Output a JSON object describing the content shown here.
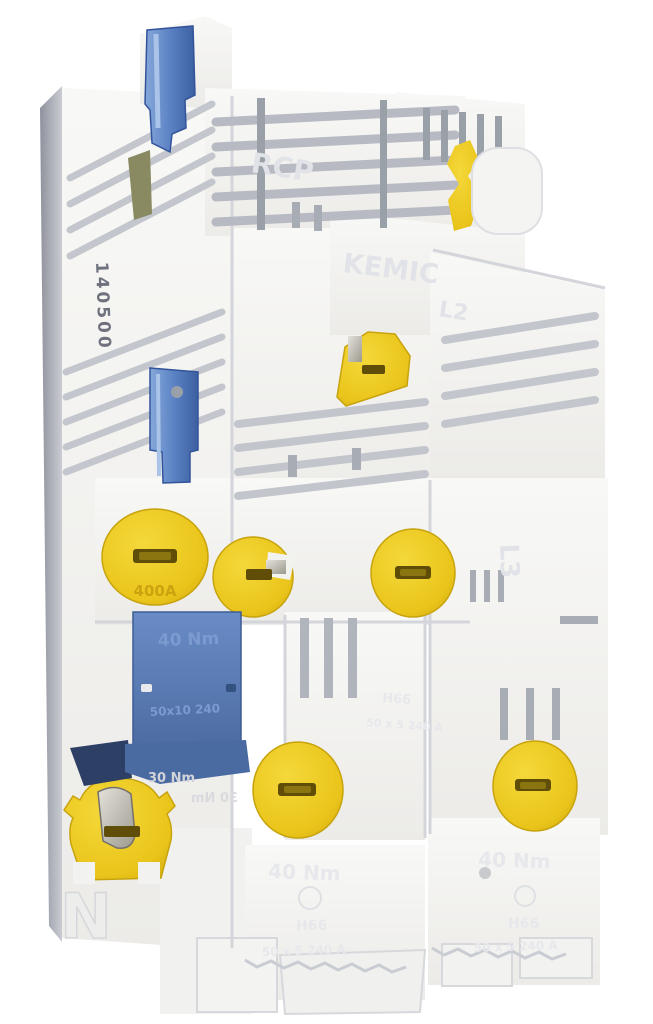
{
  "scene": {
    "type": "photograph",
    "subject": "White molded 3-pole NH fuse switch-disconnector / busbar terminal block with yellow screw caps, yellow clips and blue levers, photographed at a slight angle on a plain white background",
    "background": "#ffffff"
  },
  "palette": {
    "plastic_white": "#f4f3f1",
    "plastic_shade": "#d9dbdf",
    "plastic_deep": "#b4b8c0",
    "side_shadow": "#9a9da7",
    "lever_blue": "#5b82c4",
    "lever_blue_dark": "#3c5fa0",
    "box_blue": "#5d7fba",
    "cap_yellow": "#eac51b",
    "cap_yellow_dark": "#c7a30e",
    "slot_dark": "#5f4d08",
    "metal_grey": "#c6c4bb"
  },
  "markings": {
    "serial_stamp": "140500",
    "neutral": "N",
    "phase_right": "L3",
    "phase_center": "L2",
    "emboss_top": "RCP",
    "emboss_center": "KEMIC",
    "torque_40": "40 Nm",
    "torque_30": "30 Nm",
    "blue_box_size": "50x10 240",
    "cap_rating": "400A",
    "cover_model": "H66",
    "cover_rating": "50 x 5 240 A"
  }
}
